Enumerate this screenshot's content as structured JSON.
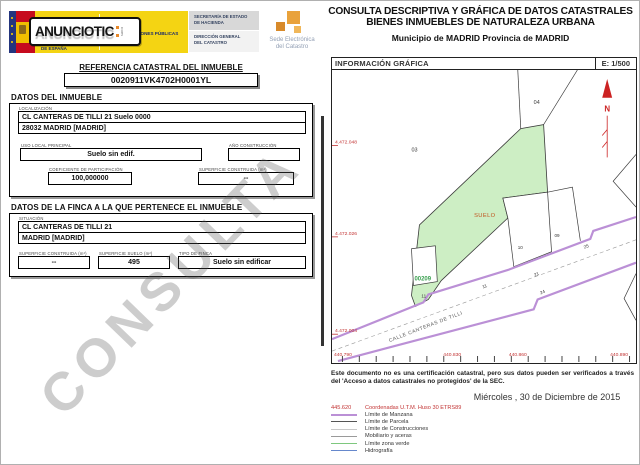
{
  "header": {
    "stamp": {
      "text": "ANUNCIOTIC",
      "sub": "com"
    },
    "gobierno": "GOBIERNO\nDE ESPAÑA",
    "ministerio": "MINISTERIO\nDE HACIENDA\nY ADMINISTRACIONES PÚBLICAS",
    "secretaria": "SECRETARÍA DE ESTADO\nDE HACIENDA",
    "direccion": "DIRECCIÓN GENERAL\nDEL CATASTRO",
    "sede": "Sede Electrónica\ndel Catastro"
  },
  "title": {
    "line1": "CONSULTA DESCRIPTIVA Y GRÁFICA DE DATOS CATASTRALES",
    "line2": "BIENES INMUEBLES DE NATURALEZA URBANA",
    "municipio": "Municipio de MADRID Provincia de MADRID"
  },
  "referencia": {
    "label": "REFERENCIA CATASTRAL DEL INMUEBLE",
    "value": "0020911VK4702H0001YL"
  },
  "datos_inmueble": {
    "heading": "DATOS DEL INMUEBLE",
    "localizacion_label": "LOCALIZACIÓN",
    "localizacion_line1": "CL CANTERAS DE TILLI 21 Suelo 0000",
    "localizacion_line2": "28032 MADRID [MADRID]",
    "uso_label": "USO LOCAL PRINCIPAL",
    "uso_value": "Suelo sin edif.",
    "ano_label": "AÑO CONSTRUCCIÓN",
    "ano_value": "",
    "coef_label": "COEFICIENTE DE PARTICIPACIÓN",
    "coef_value": "100,000000",
    "sup_label": "SUPERFICIE CONSTRUIDA (m²)",
    "sup_value": "--"
  },
  "datos_finca": {
    "heading": "DATOS DE LA FINCA A LA QUE PERTENECE EL INMUEBLE",
    "situacion_label": "SITUACIÓN",
    "situacion_line1": "CL CANTERAS DE TILLI 21",
    "situacion_line2": "MADRID [MADRID]",
    "sup_constr_label": "SUPERFICIE CONSTRUIDA (m²)",
    "sup_constr_value": "--",
    "sup_suelo_label": "SUPERFICIE SUELO (m²)",
    "sup_suelo_value": "495",
    "tipo_label": "TIPO DE FINCA",
    "tipo_value": "Suelo sin edificar"
  },
  "map": {
    "header": "INFORMACIÓN GRÁFICA",
    "scale": "E: 1/500",
    "north_letter": "N",
    "y_coords": [
      "4.472.048",
      "4.472.026",
      "4.472.004"
    ],
    "x_coords": [
      "440.790",
      "440.830",
      "440.860",
      "440.890"
    ],
    "labels": {
      "manzana": "00209",
      "suelo": "SUELO",
      "parcel_03": "03",
      "parcel_04": "04",
      "num_09": "09",
      "num_10": "10",
      "num_11": "11"
    },
    "street_numbers": [
      "11",
      "21",
      "25",
      "24"
    ],
    "street_name": "CALLE CANTERAS DE TILLI",
    "colors": {
      "parcel_fill": "#cdeec4",
      "street_line": "#bb90d6",
      "coords_red": "#c23333",
      "manzana_green": "#3aa050"
    }
  },
  "footer": {
    "disclaimer": "Este documento no es una certificación catastral, pero sus datos pueden ser verificados a través del 'Acceso a datos catastrales no protegidos' de la SEC.",
    "date": "Miércoles , 30 de Diciembre de 2015",
    "legend": [
      {
        "sample": "445.620",
        "label": "Coordenadas U.T.M. Huso 30 ETRS89",
        "color": "#c23333"
      },
      {
        "label": "Límite de Manzana",
        "color": "#bb90d6"
      },
      {
        "label": "Límite de Parcela",
        "color": "#555555"
      },
      {
        "label": "Límite de Construcciones",
        "color": "#c9c9c9"
      },
      {
        "label": "Mobiliario y aceras",
        "color": "#9a9a9a"
      },
      {
        "label": "Límite zona verde",
        "color": "#7ec87e"
      },
      {
        "label": "Hidrografía",
        "color": "#6688cc"
      }
    ]
  },
  "watermark": "CONSULTA"
}
